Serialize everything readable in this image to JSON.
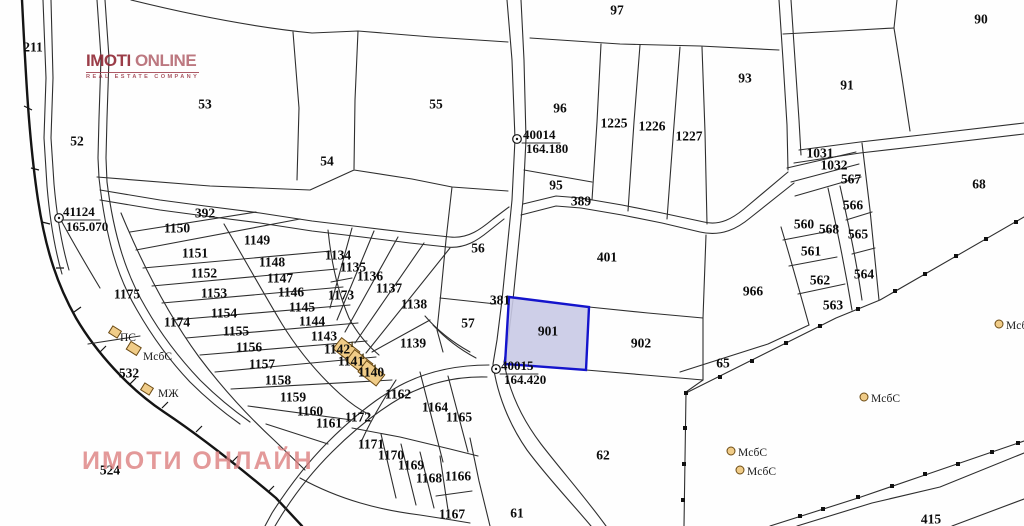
{
  "map": {
    "logo": {
      "line1_bold": "IMOTI",
      "line1_light": "ONLINE",
      "line2": "REAL ESTATE COMPANY",
      "color": "#8e2330"
    },
    "watermark": {
      "text": "ИМОТИ ОНЛАЙН",
      "color": "#dd8080"
    },
    "colors": {
      "line": "#2e2e2e",
      "highlight_fill": "#c9cae6",
      "highlight_stroke": "#1414cc",
      "building_fill": "#f0cc88",
      "building_stroke": "#6b4a14"
    },
    "highlighted_parcel": {
      "number": "901",
      "fill": "#c9cae6",
      "stroke": "#1414cc"
    },
    "parcel_labels": [
      {
        "t": "211",
        "x": 33,
        "y": 47
      },
      {
        "t": "52",
        "x": 77,
        "y": 141
      },
      {
        "t": "53",
        "x": 205,
        "y": 104
      },
      {
        "t": "54",
        "x": 327,
        "y": 161
      },
      {
        "t": "55",
        "x": 436,
        "y": 104
      },
      {
        "t": "97",
        "x": 617,
        "y": 10
      },
      {
        "t": "96",
        "x": 560,
        "y": 108
      },
      {
        "t": "1225",
        "x": 614,
        "y": 123
      },
      {
        "t": "1226",
        "x": 652,
        "y": 126
      },
      {
        "t": "1227",
        "x": 689,
        "y": 136
      },
      {
        "t": "93",
        "x": 745,
        "y": 78
      },
      {
        "t": "91",
        "x": 847,
        "y": 85
      },
      {
        "t": "90",
        "x": 981,
        "y": 19
      },
      {
        "t": "68",
        "x": 979,
        "y": 184
      },
      {
        "t": "95",
        "x": 556,
        "y": 185
      },
      {
        "t": "56",
        "x": 478,
        "y": 248
      },
      {
        "t": "57",
        "x": 468,
        "y": 323
      },
      {
        "t": "401",
        "x": 607,
        "y": 257
      },
      {
        "t": "901",
        "x": 548,
        "y": 331
      },
      {
        "t": "902",
        "x": 641,
        "y": 343
      },
      {
        "t": "966",
        "x": 753,
        "y": 291
      },
      {
        "t": "1031",
        "x": 820,
        "y": 153
      },
      {
        "t": "1032",
        "x": 834,
        "y": 165
      },
      {
        "t": "567",
        "x": 851,
        "y": 179
      },
      {
        "t": "566",
        "x": 853,
        "y": 205
      },
      {
        "t": "560",
        "x": 804,
        "y": 224
      },
      {
        "t": "568",
        "x": 829,
        "y": 229
      },
      {
        "t": "565",
        "x": 858,
        "y": 234
      },
      {
        "t": "561",
        "x": 811,
        "y": 251
      },
      {
        "t": "564",
        "x": 864,
        "y": 274
      },
      {
        "t": "562",
        "x": 820,
        "y": 280
      },
      {
        "t": "563",
        "x": 833,
        "y": 305
      },
      {
        "t": "65",
        "x": 723,
        "y": 363
      },
      {
        "t": "62",
        "x": 603,
        "y": 455
      },
      {
        "t": "61",
        "x": 517,
        "y": 513
      },
      {
        "t": "524",
        "x": 110,
        "y": 470
      },
      {
        "t": "532",
        "x": 129,
        "y": 373
      },
      {
        "t": "1150",
        "x": 177,
        "y": 228
      },
      {
        "t": "1149",
        "x": 257,
        "y": 240
      },
      {
        "t": "1151",
        "x": 195,
        "y": 253
      },
      {
        "t": "1148",
        "x": 272,
        "y": 262
      },
      {
        "t": "1152",
        "x": 204,
        "y": 273
      },
      {
        "t": "1147",
        "x": 280,
        "y": 278
      },
      {
        "t": "1153",
        "x": 214,
        "y": 293
      },
      {
        "t": "1146",
        "x": 291,
        "y": 292
      },
      {
        "t": "1175",
        "x": 127,
        "y": 294
      },
      {
        "t": "1145",
        "x": 302,
        "y": 307
      },
      {
        "t": "1154",
        "x": 224,
        "y": 313
      },
      {
        "t": "1144",
        "x": 312,
        "y": 321
      },
      {
        "t": "1174",
        "x": 177,
        "y": 322
      },
      {
        "t": "1155",
        "x": 236,
        "y": 331
      },
      {
        "t": "1143",
        "x": 324,
        "y": 336
      },
      {
        "t": "1156",
        "x": 249,
        "y": 347
      },
      {
        "t": "1142",
        "x": 337,
        "y": 349
      },
      {
        "t": "1157",
        "x": 262,
        "y": 364
      },
      {
        "t": "1141",
        "x": 351,
        "y": 361
      },
      {
        "t": "1140",
        "x": 371,
        "y": 372
      },
      {
        "t": "1158",
        "x": 278,
        "y": 380
      },
      {
        "t": "1159",
        "x": 293,
        "y": 397
      },
      {
        "t": "1160",
        "x": 310,
        "y": 411
      },
      {
        "t": "1161",
        "x": 329,
        "y": 423
      },
      {
        "t": "1134",
        "x": 338,
        "y": 255
      },
      {
        "t": "1135",
        "x": 353,
        "y": 267
      },
      {
        "t": "1136",
        "x": 370,
        "y": 276
      },
      {
        "t": "1137",
        "x": 389,
        "y": 288
      },
      {
        "t": "1173",
        "x": 341,
        "y": 295
      },
      {
        "t": "1138",
        "x": 414,
        "y": 304
      },
      {
        "t": "1139",
        "x": 413,
        "y": 343
      },
      {
        "t": "1162",
        "x": 398,
        "y": 394
      },
      {
        "t": "1172",
        "x": 358,
        "y": 417
      },
      {
        "t": "1164",
        "x": 435,
        "y": 407
      },
      {
        "t": "1165",
        "x": 459,
        "y": 417
      },
      {
        "t": "1171",
        "x": 371,
        "y": 444
      },
      {
        "t": "1170",
        "x": 391,
        "y": 455
      },
      {
        "t": "1169",
        "x": 411,
        "y": 465
      },
      {
        "t": "1168",
        "x": 429,
        "y": 478
      },
      {
        "t": "1166",
        "x": 458,
        "y": 476
      },
      {
        "t": "1167",
        "x": 452,
        "y": 514
      }
    ],
    "road_labels": [
      {
        "t": "392",
        "x": 205,
        "y": 213
      },
      {
        "t": "389",
        "x": 581,
        "y": 201
      },
      {
        "t": "381",
        "x": 500,
        "y": 300
      },
      {
        "t": "415",
        "x": 931,
        "y": 519
      }
    ],
    "survey_points": [
      {
        "id": "41124",
        "elev": "165.070",
        "x": 59,
        "y": 218,
        "lx": 63,
        "ly": 216,
        "ex": 66,
        "ey": 231
      },
      {
        "id": "40014",
        "elev": "164.180",
        "x": 517,
        "y": 139,
        "lx": 523,
        "ly": 139,
        "ex": 526,
        "ey": 153
      },
      {
        "id": "40015",
        "elev": "164.420",
        "x": 496,
        "y": 369,
        "lx": 501,
        "ly": 370,
        "ex": 504,
        "ey": 384
      }
    ],
    "building_labels": [
      {
        "t": "ПС",
        "x": 120,
        "y": 341,
        "icon": "rect",
        "ix": 113,
        "iy": 330
      },
      {
        "t": "МсбС",
        "x": 143,
        "y": 360,
        "icon": "rect",
        "ix": 131,
        "iy": 346
      },
      {
        "t": "МЖ",
        "x": 158,
        "y": 397,
        "icon": "rect",
        "ix": 145,
        "iy": 387
      },
      {
        "t": "МсбС",
        "x": 871,
        "y": 402,
        "icon": "circle",
        "ix": 864,
        "iy": 397
      },
      {
        "t": "МсбС",
        "x": 1006,
        "y": 329,
        "icon": "circle",
        "ix": 999,
        "iy": 324
      },
      {
        "t": "МсбС",
        "x": 738,
        "y": 456,
        "icon": "circle",
        "ix": 731,
        "iy": 451
      },
      {
        "t": "МсбС",
        "x": 747,
        "y": 475,
        "icon": "circle",
        "ix": 740,
        "iy": 470
      }
    ],
    "building_floor_marks": [
      {
        "t": "1",
        "x": 352,
        "y": 347
      },
      {
        "t": "1",
        "x": 363,
        "y": 359
      },
      {
        "t": "1",
        "x": 375,
        "y": 370
      }
    ]
  }
}
